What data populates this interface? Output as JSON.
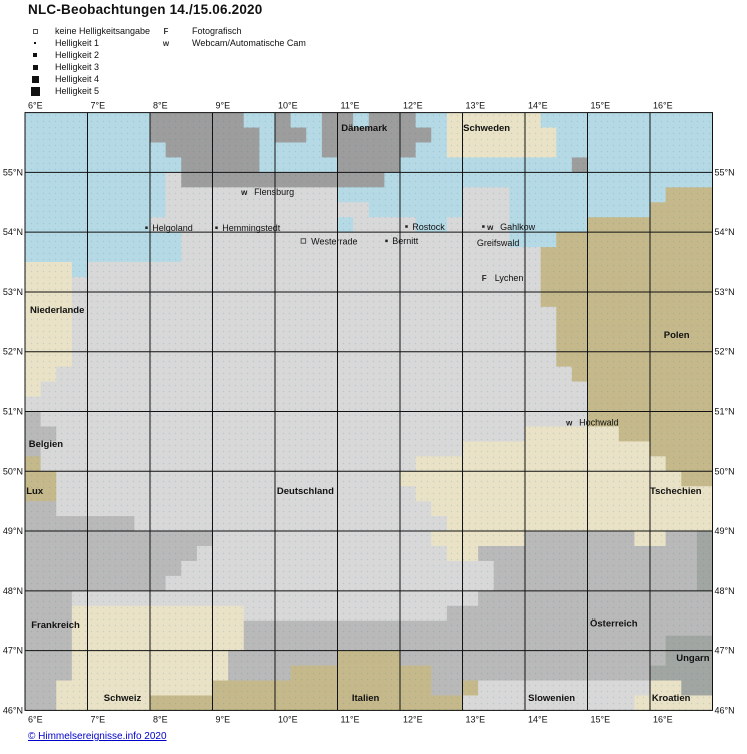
{
  "title": "NLC-Beobachtungen 14./15.06.2020",
  "footer": {
    "link_label": "© Himmelsereignisse.info 2020",
    "link_color": "#0000cc"
  },
  "legend": {
    "brightness": [
      {
        "symbol": "square-hollow",
        "label": "keine Helligkeitsangabe"
      },
      {
        "symbol": "dot-1",
        "label": "Helligkeit 1"
      },
      {
        "symbol": "dot-2",
        "label": "Helligkeit 2"
      },
      {
        "symbol": "dot-3",
        "label": "Helligkeit 3"
      },
      {
        "symbol": "dot-4",
        "label": "Helligkeit 4"
      },
      {
        "symbol": "dot-5",
        "label": "Helligkeit 5"
      }
    ],
    "types": [
      {
        "symbol": "F",
        "label": "Fotografisch"
      },
      {
        "symbol": "w",
        "label": "Webcam/Automatische Cam"
      }
    ]
  },
  "chart_data": {
    "type": "heatmap",
    "title": "NLC-Beobachtungen 14./15.06.2020",
    "xlabel": "Längengrad (°E)",
    "ylabel": "Breitengrad (°N)",
    "lon_range": [
      6,
      17
    ],
    "lat_range": [
      46,
      56
    ],
    "lon_ticks": [
      "6°E",
      "7°E",
      "8°E",
      "9°E",
      "10°E",
      "11°E",
      "12°E",
      "13°E",
      "14°E",
      "15°E",
      "16°E"
    ],
    "lat_ticks": [
      "55°N",
      "54°N",
      "53°N",
      "52°N",
      "51°N",
      "50°N",
      "49°N",
      "48°N",
      "47°N",
      "46°N"
    ],
    "grid": true,
    "legend_position": "top-left",
    "observations": [
      {
        "name": "Flensburg",
        "type": "Webcam",
        "lon": 9.49,
        "lat": 54.67
      },
      {
        "name": "Helgoland",
        "type": "Helligkeit 1",
        "lon": 7.94,
        "lat": 54.07
      },
      {
        "name": "Hemmingstedt",
        "type": "Helligkeit 1",
        "lon": 9.06,
        "lat": 54.07
      },
      {
        "name": "Westerrade",
        "type": "keine Helligkeitsangabe",
        "lon": 10.45,
        "lat": 53.84
      },
      {
        "name": "Rostock",
        "type": "Helligkeit 1",
        "lon": 12.1,
        "lat": 54.09
      },
      {
        "name": "Bernitt",
        "type": "Helligkeit 1",
        "lon": 11.78,
        "lat": 53.85
      },
      {
        "name": "Gahlkow",
        "type": "Helligkeit 1 + Webcam",
        "lon": 13.33,
        "lat": 54.09
      },
      {
        "name": "Greifswald",
        "type": "Station",
        "lon": 13.23,
        "lat": 53.82
      },
      {
        "name": "Lychen",
        "type": "Fotografisch",
        "lon": 13.34,
        "lat": 53.23
      },
      {
        "name": "Hochwald",
        "type": "Webcam",
        "lon": 14.69,
        "lat": 50.82
      }
    ]
  },
  "axis": {
    "lon_labels": [
      "6°E",
      "7°E",
      "8°E",
      "9°E",
      "10°E",
      "11°E",
      "12°E",
      "13°E",
      "14°E",
      "15°E",
      "16°E"
    ],
    "lat_labels": [
      "55°N",
      "54°N",
      "53°N",
      "52°N",
      "51°N",
      "50°N",
      "49°N",
      "48°N",
      "47°N",
      "46°N"
    ]
  },
  "map": {
    "bounds": {
      "lon_min": 6,
      "lon_max": 17,
      "lat_min": 46,
      "lat_max": 56
    },
    "frame": {
      "x0": 25,
      "y0": 112.6,
      "px_per_lon": 62.5,
      "px_per_lat": 59.78
    },
    "palette": {
      ".": "#b5dae6",
      "d": "#9d9d9d",
      "g": "#d8d8d8",
      "f": "#b9b9b9",
      "h": "#a2a6a2",
      "n": "#e9e2c6",
      "p": "#c5b98b"
    },
    "palette_legend": {
      "water": ".",
      "daenemark_gray": "d",
      "deutschland_hellgrau": "g",
      "frankreich_oesterreich_grau": "f",
      "ungarn_dunkelgrau": "h",
      "beige_schweden_nl_schweiz_tschechien": "n",
      "khaki_polen_italien_lux": "p"
    },
    "rows": [
      "........dddddd..d..dd.ddd..nnnnnn...........",
      "........ddddddd.dd.ddddddd.nnnnnnn..........",
      ".........dddddd....dddddd..nnnnnnn..........",
      "..........ddddd.....dddd...........d........",
      ".........gddddddddddddd.....................",
      ".........ggggggggggg........ggg..........ppp",
      ".........ggggggggggggg......ggg.........pppp",
      "........gggggggggggg.gggg..gggg.....pppppppp",
      "..........ggggggggggggggggggggg...pppppppppp",
      "..........gggggggggggggggggggggggppppppppppp",
      "nnn.gggggggggggggggggggggggggggggppppppppppp",
      "nnnggggggggggggggggggggggggggggggppppppppppp",
      "nnnggggggggggggggggggggggggggggggppppppppppp",
      "nnngggggggggggggggggggggggggggggggpppppppppp",
      "nnngggggggggggggggggggggggggggggggpppppppppp",
      "nnngggggggggggggggggggggggggggggggpppppppppp",
      "nnngggggggggggggggggggggggggggggggpppppppppp",
      "nngggggggggggggggggggggggggggggggggppppppppp",
      "ngggggggggggggggggggggggggggggggggggpppppppp",
      "ggggggggggggggggggggggggggggggggggggpppppppp",
      "fgggggggggggggggggggggggggggggggggggpppppppp",
      "ffggggggggggggggggggggggggggggggnnnnnnpppppp",
      "fgggggggggggggggggggggggggggnnnnnnnnnnnnpppp",
      "pggggggggggggggggggggggggnnnnnnnnnnnnnnnnppp",
      "ppggggggggggggggggggggggnnnnnnnnnnnnnnnnnnpp",
      "ppgggggggggggggggggggggggnnnnnnnnnnnnnnnnnnn",
      "ffggggggggggggggggggggggggnnnnnnnnnnnnnnnnnn",
      "fffffffggggggggggggggggggggnnnnnnnnnnnnnnnnn",
      "ffffffffffffggggggggggggggnnnnnnfffffffnnffh",
      "fffffffffffggggggggggggggggnnffffffffffffffh",
      "ffffffffffggggggggggggggggggggfffffffffffffh",
      "fffffffffgggggggggggggggggggggfffffffffffffh",
      "fffggggggggggggggggggggggggggfffffffffffffff",
      "fffnnnnnnnnnnngggggggggggggfffffffffffffffff",
      "fffnnnnnnnnnnnffffffffffffffffffffffffffffff",
      "fffnnnnnnnnnnnfffffffffffffffffffffffffffhhh",
      "fffnnnnnnnnnnfffffffppppfffffffffffffffffhhh",
      "fffnnnnnnnnnnffffpppppppppffffffffffffffhhhh",
      "ffnnnnnnnnnnppppppppppppppffpgggggggggggnnhh",
      "ffnnnnnnppppppppppppppppppppgggggggggggnnnnn"
    ],
    "countries": [
      {
        "name": "Dänemark",
        "lon": 11.06,
        "lat": 55.69
      },
      {
        "name": "Schweden",
        "lon": 13.01,
        "lat": 55.69
      },
      {
        "name": "Niederlande",
        "lon": 6.08,
        "lat": 52.65
      },
      {
        "name": "Polen",
        "lon": 16.22,
        "lat": 52.23
      },
      {
        "name": "Belgien",
        "lon": 6.06,
        "lat": 50.41
      },
      {
        "name": "Lux",
        "lon": 6.02,
        "lat": 49.62
      },
      {
        "name": "Deutschland",
        "lon": 10.03,
        "lat": 49.62
      },
      {
        "name": "Tschechien",
        "lon": 16.0,
        "lat": 49.62
      },
      {
        "name": "Frankreich",
        "lon": 6.1,
        "lat": 47.38
      },
      {
        "name": "Österreich",
        "lon": 15.04,
        "lat": 47.4
      },
      {
        "name": "Ungarn",
        "lon": 16.42,
        "lat": 46.83
      },
      {
        "name": "Schweiz",
        "lon": 7.26,
        "lat": 46.16
      },
      {
        "name": "Italien",
        "lon": 11.23,
        "lat": 46.16
      },
      {
        "name": "Slowenien",
        "lon": 14.05,
        "lat": 46.16
      },
      {
        "name": "Kroatien",
        "lon": 16.03,
        "lat": 46.16
      }
    ],
    "cities": [
      {
        "name": "Flensburg",
        "symbols": [
          "w"
        ],
        "lon": 9.49,
        "lat": 54.67
      },
      {
        "name": "Helgoland",
        "symbols": [
          "dot"
        ],
        "lon": 7.94,
        "lat": 54.07
      },
      {
        "name": "Hemmingstedt",
        "symbols": [
          "dot"
        ],
        "lon": 9.06,
        "lat": 54.07
      },
      {
        "name": "Westerrade",
        "symbols": [
          "square"
        ],
        "lon": 10.45,
        "lat": 53.84
      },
      {
        "name": "Rostock",
        "symbols": [
          "dot"
        ],
        "lon": 12.1,
        "lat": 54.09
      },
      {
        "name": "Gahlkow",
        "symbols": [
          "dot",
          "w"
        ],
        "lon": 13.33,
        "lat": 54.09
      },
      {
        "name": "Bernitt",
        "symbols": [
          "dot"
        ],
        "lon": 11.78,
        "lat": 53.85
      },
      {
        "name": "Greifswald",
        "symbols": [],
        "lon": 13.23,
        "lat": 53.82
      },
      {
        "name": "Lychen",
        "symbols": [
          "F"
        ],
        "lon": 13.34,
        "lat": 53.23
      },
      {
        "name": "Hochwald",
        "symbols": [
          "w"
        ],
        "lon": 14.69,
        "lat": 50.82
      }
    ]
  }
}
